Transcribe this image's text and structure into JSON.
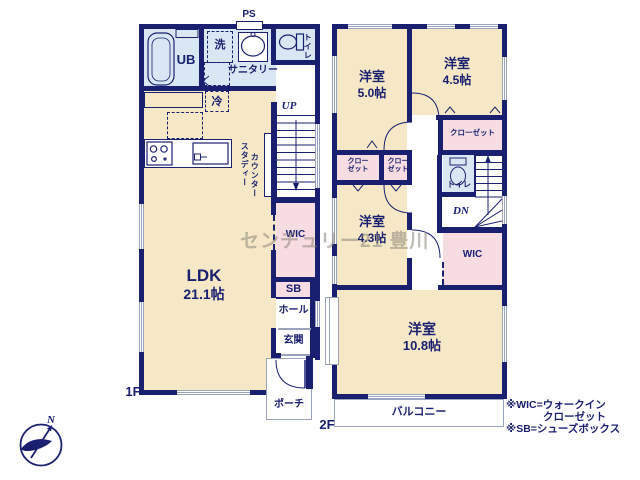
{
  "watermark": "センチュリー21 豊川",
  "compass": {
    "north": "N"
  },
  "floor1": {
    "label": "1F",
    "ps": "PS",
    "rooms": {
      "ub": "UB",
      "washer": "洗",
      "sanitary": "サニタリー",
      "toilet": "トイレ",
      "fridge": "冷",
      "study1": "スタディー",
      "study2": "カウンター",
      "up": "UP",
      "wic": "WIC",
      "ldk_name": "LDK",
      "ldk_size": "21.1帖",
      "sb": "SB",
      "hall": "ホール",
      "entrance": "玄関",
      "porch": "ポーチ"
    }
  },
  "floor2": {
    "label": "2F",
    "rooms": {
      "r50_name": "洋室",
      "r50_size": "5.0帖",
      "r45_name": "洋室",
      "r45_size": "4.5帖",
      "r43_name": "洋室",
      "r43_size": "4.3帖",
      "r108_name": "洋室",
      "r108_size": "10.8帖",
      "closet_main": "クローゼット",
      "closet_a1": "クロー",
      "closet_a2": "ゼット",
      "closet_b1": "クロー",
      "closet_b2": "ゼット",
      "toilet": "トイレ",
      "dn": "DN",
      "wic": "WIC",
      "balcony": "バルコニー"
    }
  },
  "legend": {
    "line1": "※WIC=ウォークイン",
    "line2": "クローゼット",
    "line3": "※SB=シューズボックス"
  },
  "colors": {
    "wall": "#1a2070",
    "room_floor": "#f6e8c6",
    "closet": "#f7dce2",
    "wet_area": "#d9e6f3",
    "window": "#9aa3bc",
    "watermark": "#8b857a"
  }
}
